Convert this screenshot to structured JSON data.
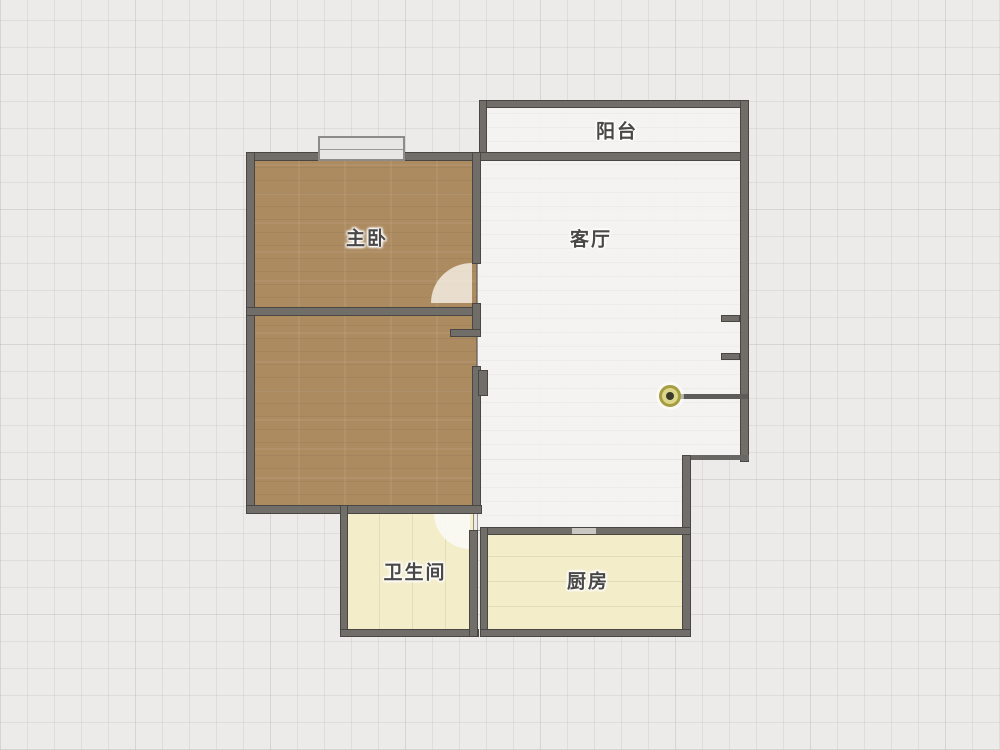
{
  "floorplan": {
    "title": "apartment-floor-plan",
    "rooms": [
      {
        "id": "balcony",
        "label": "阳台"
      },
      {
        "id": "master-bedroom",
        "label": "主卧"
      },
      {
        "id": "living-room",
        "label": "客厅"
      },
      {
        "id": "second-bedroom",
        "label": ""
      },
      {
        "id": "bathroom",
        "label": "卫生间"
      },
      {
        "id": "kitchen",
        "label": "厨房"
      }
    ],
    "colors": {
      "background": "#ecebe9",
      "grid_line": "#d9d8d5",
      "wall": "#5f5c58",
      "bedroom_floor": "#ad8b61",
      "living_floor": "#f4f3f1",
      "service_floor": "#f4edca",
      "door_knob_ring": "#a69e3e",
      "label_text": "#4a4846"
    }
  }
}
